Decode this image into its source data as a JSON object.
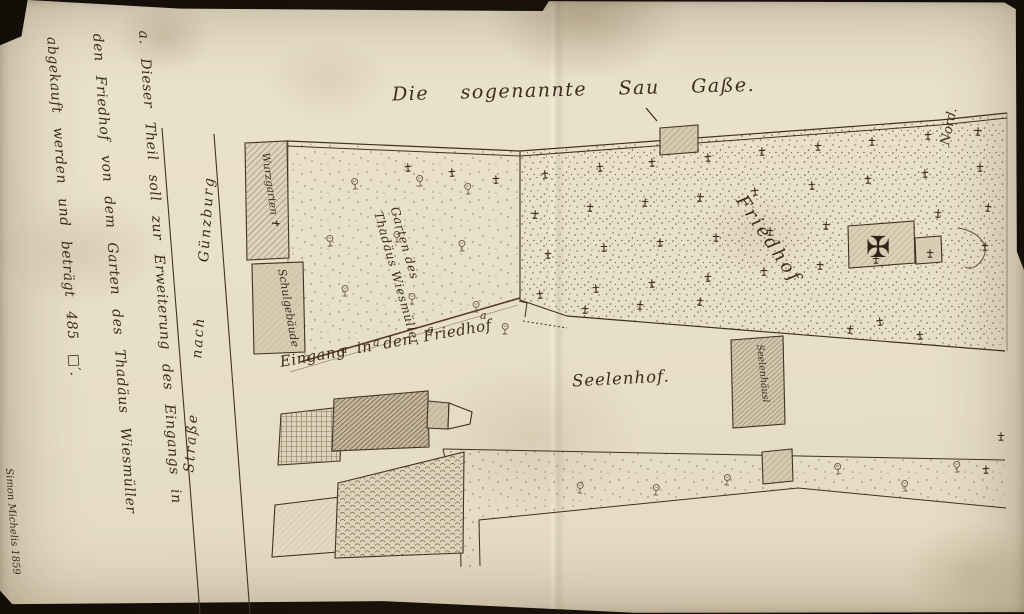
{
  "map": {
    "title": "Die sogenannte Sau Gaße.",
    "north_label": "Nord.",
    "monument_cross_glyph": "✠",
    "labels": {
      "friedhof": "Friedhof",
      "seelenhof": "Seelenhof.",
      "eingang": "Eingang in den Friedhof",
      "road": "Straße nach Günzburg",
      "garden_line1": "Garten des",
      "garden_line2": "Thadäus Wiesmüller",
      "building_garden": "Wurzgarten ✝",
      "building_school": "Schulgebäude",
      "seelenhaus": "Seelenhäusl",
      "path_markers": [
        "a",
        "a",
        "a",
        "a",
        "a"
      ]
    },
    "margin_note": {
      "lines": [
        "a. Dieser Theil soll zur Erweiterung des Eingangs in",
        "den Friedhof von dem Garten des Thadäus Wiesmüller",
        "abgekauft werden und beträgt 485 □′."
      ],
      "signature": "Simon Michelis 1859"
    },
    "colors": {
      "ink": "#3f3020",
      "paper": "#e8dfc8",
      "hatch": "#8d7a5f"
    }
  }
}
